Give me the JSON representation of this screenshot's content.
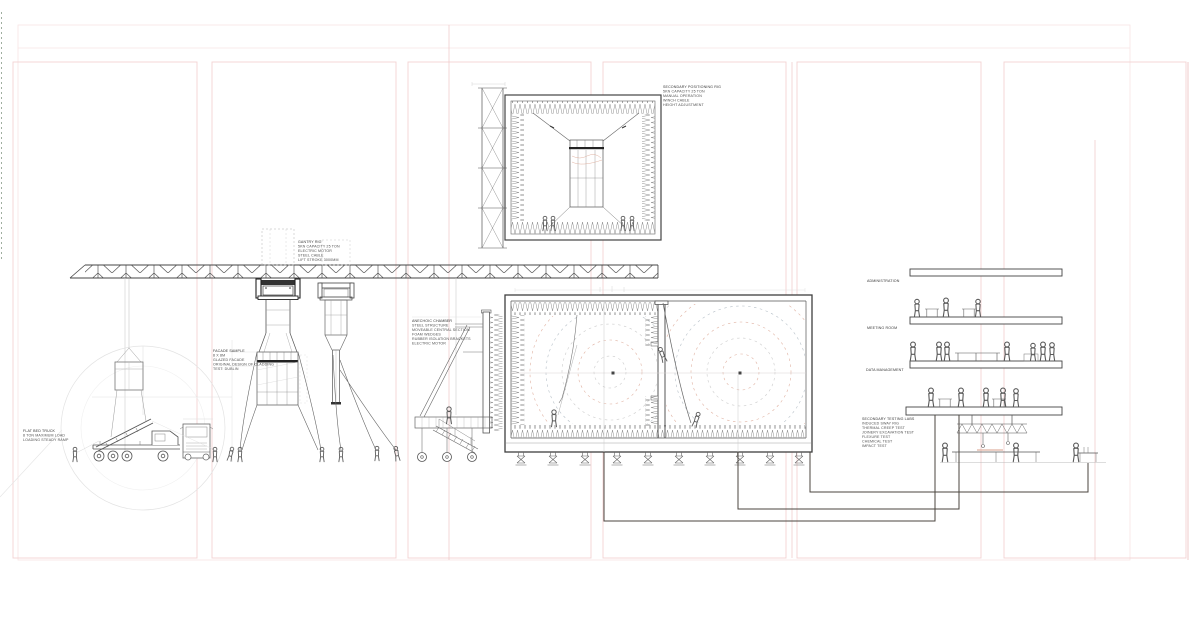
{
  "annotations": {
    "flat_bed_truck": {
      "lines": [
        "FLAT BED TRUCK",
        "8 TON MAXIMUM LOAD",
        "LOADING STEADY RAMP"
      ]
    },
    "facade_sample": {
      "lines": [
        "FACADE SAMPLE",
        "8 X 8M",
        "GLAZED FACADE",
        "ORIGINAL DESIGN OF CLADDING",
        "TEST: DUBLIN"
      ]
    },
    "gantry_rig": {
      "lines": [
        "GANTRY RIG",
        "5KN CAPACITY 25 TON",
        "ELECTRIC MOTOR",
        "STEEL CABLE",
        "LIFT STROKE 3000MM"
      ]
    },
    "anechoic_chamber": {
      "lines": [
        "ANECHOIC CHAMBER",
        "STEEL STRUCTURE",
        "MOVEABLE CENTRAL SECTION",
        "FOAM WEDGES",
        "RUBBER ISOLATION BRACKETS",
        "ELECTRIC MOTOR"
      ]
    },
    "secondary_positioning_rig": {
      "lines": [
        "SECONDARY POSITIONING RIG",
        "5KN CAPACITY 25 TON",
        "MANUAL OPERATION",
        "WINCH CABLE",
        "HEIGHT ADJUSTMENT"
      ]
    },
    "secondary_testing_labs": {
      "lines": [
        "SECONDARY TESTING LABS",
        "INDUCED SWAY RIG",
        "THERMAL CREEP TEST",
        "JOINERY EXCAVATION TEST",
        "FLEXURE TEST",
        "CHEMICAL TEST",
        "IMPACT TEST"
      ]
    }
  },
  "floor_labels": {
    "administration": "ADMINISTRATION",
    "meeting_room": "MEETING ROOM",
    "data_management": "DATA MANAGEMENT"
  },
  "colors": {
    "background": "#ffffff",
    "panel_pink": "#f3d3d3",
    "panel_pink_faint": "#f8e5e5",
    "accent_pink": "#eec6c6",
    "ink_dark": "#3f3f3f",
    "ink_mid": "#6b6b6b",
    "ink_light": "#c9c9c9",
    "wave_salmon": "#e0b2a2",
    "wave_blue": "#b7c0c8",
    "route_brown": "#4b453f",
    "text_gray": "#4f4f4f",
    "dash_green": "#9fae9f"
  }
}
